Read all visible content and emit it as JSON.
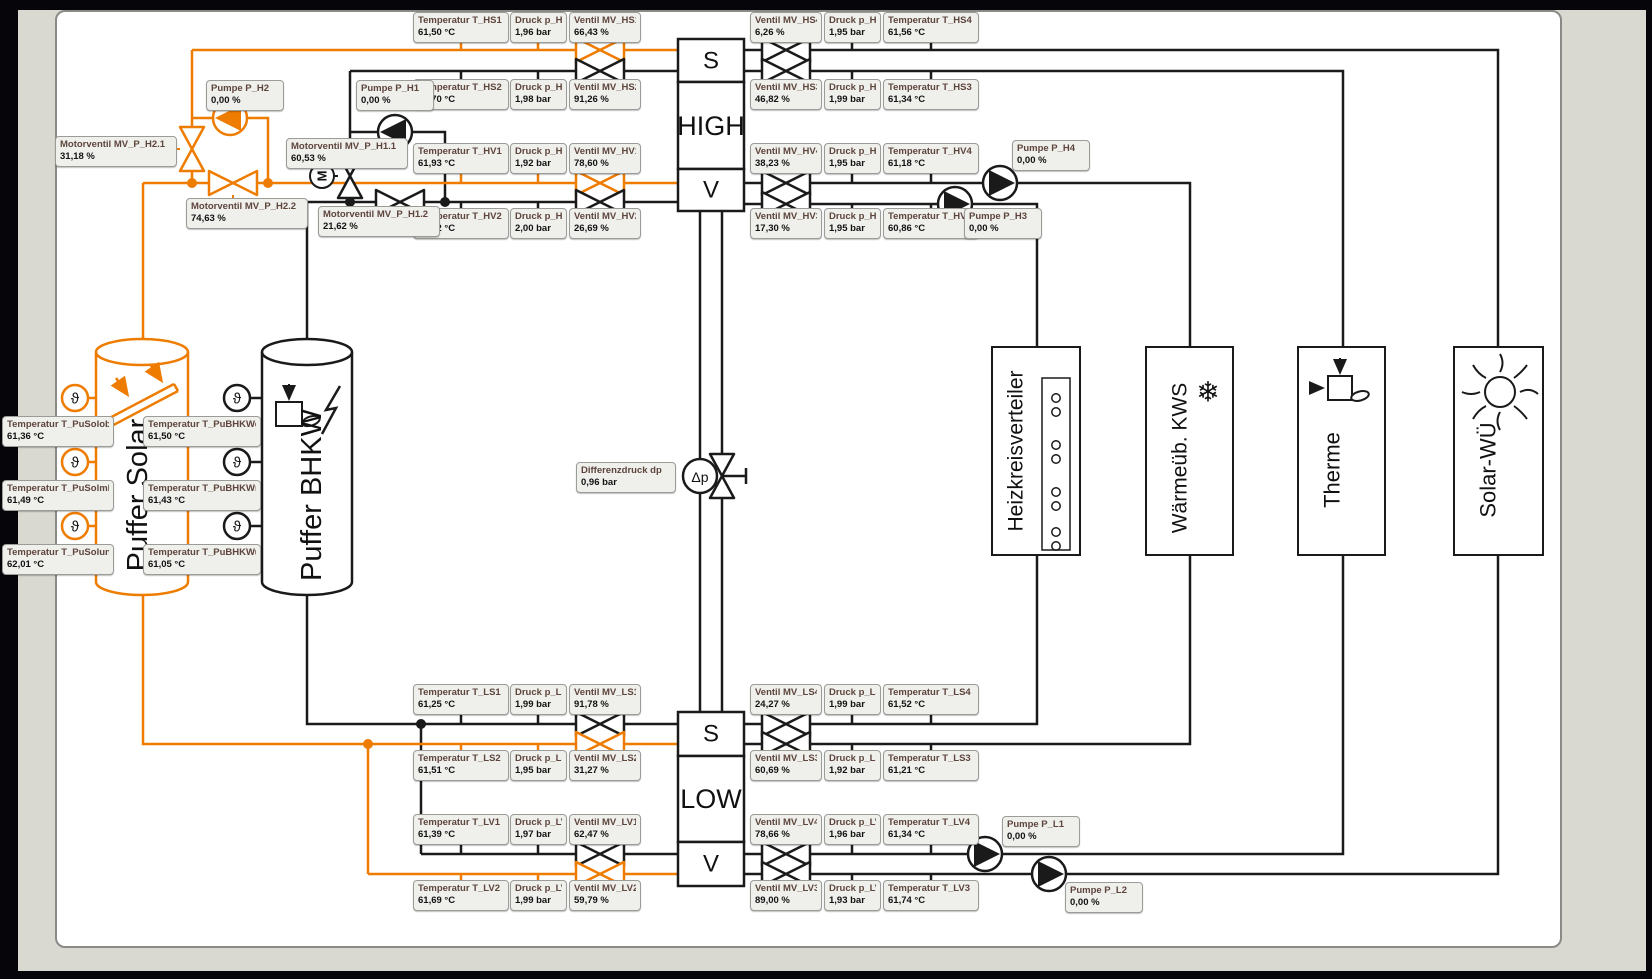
{
  "colors": {
    "orange": "#EE7C00",
    "black": "#1A1A1A",
    "canvas": "#FFFFFF",
    "mat": "#D9D9D1",
    "label_bg": "#EFEFEC"
  },
  "units": {
    "puffer_solar": "Puffer Solar",
    "puffer_bhkw": "Puffer BHKW",
    "heizkreisverteiler": "Heizkreisverteiler",
    "kws": "Wärmeüb. KWS",
    "therme": "Therme",
    "solar_wu": "Solar-WÜ"
  },
  "blocks": {
    "high": {
      "s": "S",
      "name": "HIGH",
      "v": "V"
    },
    "low": {
      "s": "S",
      "name": "LOW",
      "v": "V"
    }
  },
  "symbols": {
    "motor": "M",
    "theta": "ϑ",
    "dp": "Δp",
    "snow": "❄"
  },
  "labels": {
    "t_hs1": {
      "t": "Temperatur T_HS1",
      "v": "61,50 °C"
    },
    "p_hs1": {
      "t": "Druck p_HS1",
      "v": "1,96 bar"
    },
    "mv_hs1": {
      "t": "Ventil MV_HS1",
      "v": "66,43 %"
    },
    "t_hs2": {
      "t": "Temperatur T_HS2",
      "v": "61,70 °C"
    },
    "p_hs2": {
      "t": "Druck p_HS2",
      "v": "1,98 bar"
    },
    "mv_hs2": {
      "t": "Ventil MV_HS2",
      "v": "91,26 %"
    },
    "t_hv1": {
      "t": "Temperatur T_HV1",
      "v": "61,93 °C"
    },
    "p_hv1": {
      "t": "Druck p_HV1",
      "v": "1,92 bar"
    },
    "mv_hv1": {
      "t": "Ventil MV_HV1",
      "v": "78,60 %"
    },
    "t_hv2": {
      "t": "Temperatur T_HV2",
      "v": "61,92 °C"
    },
    "p_hv2": {
      "t": "Druck p_HV2",
      "v": "2,00 bar"
    },
    "mv_hv2": {
      "t": "Ventil MV_HV2",
      "v": "26,69 %"
    },
    "mv_hs4": {
      "t": "Ventil MV_HS4",
      "v": "6,26 %"
    },
    "p_hs4": {
      "t": "Druck p_HS4",
      "v": "1,95 bar"
    },
    "t_hs4": {
      "t": "Temperatur T_HS4",
      "v": "61,56 °C"
    },
    "mv_hs3": {
      "t": "Ventil MV_HS3",
      "v": "46,82 %"
    },
    "p_hs3": {
      "t": "Druck p_HS3",
      "v": "1,99 bar"
    },
    "t_hs3": {
      "t": "Temperatur T_HS3",
      "v": "61,34 °C"
    },
    "mv_hv4": {
      "t": "Ventil MV_HV4",
      "v": "38,23 %"
    },
    "p_hv4": {
      "t": "Druck p_HV4",
      "v": "1,95 bar"
    },
    "t_hv4": {
      "t": "Temperatur T_HV4",
      "v": "61,18 °C"
    },
    "mv_hv3": {
      "t": "Ventil MV_HV3",
      "v": "17,30 %"
    },
    "p_hv3": {
      "t": "Druck p_HV3",
      "v": "1,95 bar"
    },
    "t_hv3": {
      "t": "Temperatur T_HV3",
      "v": "60,86 °C"
    },
    "t_ls1": {
      "t": "Temperatur T_LS1",
      "v": "61,25 °C"
    },
    "p_ls1": {
      "t": "Druck p_LS1",
      "v": "1,99 bar"
    },
    "mv_ls1": {
      "t": "Ventil MV_LS1",
      "v": "91,78 %"
    },
    "t_ls2": {
      "t": "Temperatur T_LS2",
      "v": "61,51 °C"
    },
    "p_ls2": {
      "t": "Druck p_LS2",
      "v": "1,95 bar"
    },
    "mv_ls2": {
      "t": "Ventil MV_LS2",
      "v": "31,27 %"
    },
    "t_lv1": {
      "t": "Temperatur T_LV1",
      "v": "61,39 °C"
    },
    "p_lv1": {
      "t": "Druck p_LV1",
      "v": "1,97 bar"
    },
    "mv_lv1": {
      "t": "Ventil MV_LV1",
      "v": "62,47 %"
    },
    "t_lv2": {
      "t": "Temperatur T_LV2",
      "v": "61,69 °C"
    },
    "p_lv2": {
      "t": "Druck p_LV2",
      "v": "1,99 bar"
    },
    "mv_lv2": {
      "t": "Ventil MV_LV2",
      "v": "59,79 %"
    },
    "mv_ls4": {
      "t": "Ventil MV_LS4",
      "v": "24,27 %"
    },
    "p_ls4": {
      "t": "Druck p_LS4",
      "v": "1,99 bar"
    },
    "t_ls4": {
      "t": "Temperatur T_LS4",
      "v": "61,52 °C"
    },
    "mv_ls3": {
      "t": "Ventil MV_LS3",
      "v": "60,69 %"
    },
    "p_ls3": {
      "t": "Druck p_LS3",
      "v": "1,92 bar"
    },
    "t_ls3": {
      "t": "Temperatur T_LS3",
      "v": "61,21 °C"
    },
    "mv_lv4": {
      "t": "Ventil MV_LV4",
      "v": "78,66 %"
    },
    "p_lv4": {
      "t": "Druck p_LV4",
      "v": "1,96 bar"
    },
    "t_lv4": {
      "t": "Temperatur T_LV4",
      "v": "61,34 °C"
    },
    "mv_lv3": {
      "t": "Ventil MV_LV3",
      "v": "89,00 %"
    },
    "p_lv3": {
      "t": "Druck p_LV3",
      "v": "1,93 bar"
    },
    "t_lv3": {
      "t": "Temperatur T_LV3",
      "v": "61,74 °C"
    },
    "pumpe_h2": {
      "t": "Pumpe P_H2",
      "v": "0,00 %"
    },
    "pumpe_h1": {
      "t": "Pumpe P_H1",
      "v": "0,00 %"
    },
    "pumpe_h4": {
      "t": "Pumpe P_H4",
      "v": "0,00 %"
    },
    "pumpe_h3": {
      "t": "Pumpe P_H3",
      "v": "0,00 %"
    },
    "pumpe_l1": {
      "t": "Pumpe P_L1",
      "v": "0,00 %"
    },
    "pumpe_l2": {
      "t": "Pumpe P_L2",
      "v": "0,00 %"
    },
    "mv_p_h21": {
      "t": "Motorventil MV_P_H2.1",
      "v": "31,18 %"
    },
    "mv_p_h22": {
      "t": "Motorventil MV_P_H2.2",
      "v": "74,63 %"
    },
    "mv_p_h11": {
      "t": "Motorventil MV_P_H1.1",
      "v": "60,53 %"
    },
    "mv_p_h12": {
      "t": "Motorventil MV_P_H1.2",
      "v": "21,62 %"
    },
    "t_pusolob": {
      "t": "Temperatur T_PuSolob",
      "v": "61,36 °C"
    },
    "t_pusolml": {
      "t": "Temperatur T_PuSolml",
      "v": "61,49 °C"
    },
    "t_pusolun": {
      "t": "Temperatur T_PuSolun",
      "v": "62,01 °C"
    },
    "t_pubhkwob": {
      "t": "Temperatur T_PuBHKWob",
      "v": "61,50 °C"
    },
    "t_pubhkwml": {
      "t": "Temperatur T_PuBHKWml",
      "v": "61,43 °C"
    },
    "t_pubhkwun": {
      "t": "Temperatur T_PuBHKWun",
      "v": "61,05 °C"
    },
    "diff": {
      "t": "Differenzdruck dp",
      "v": "0,96 bar"
    }
  }
}
